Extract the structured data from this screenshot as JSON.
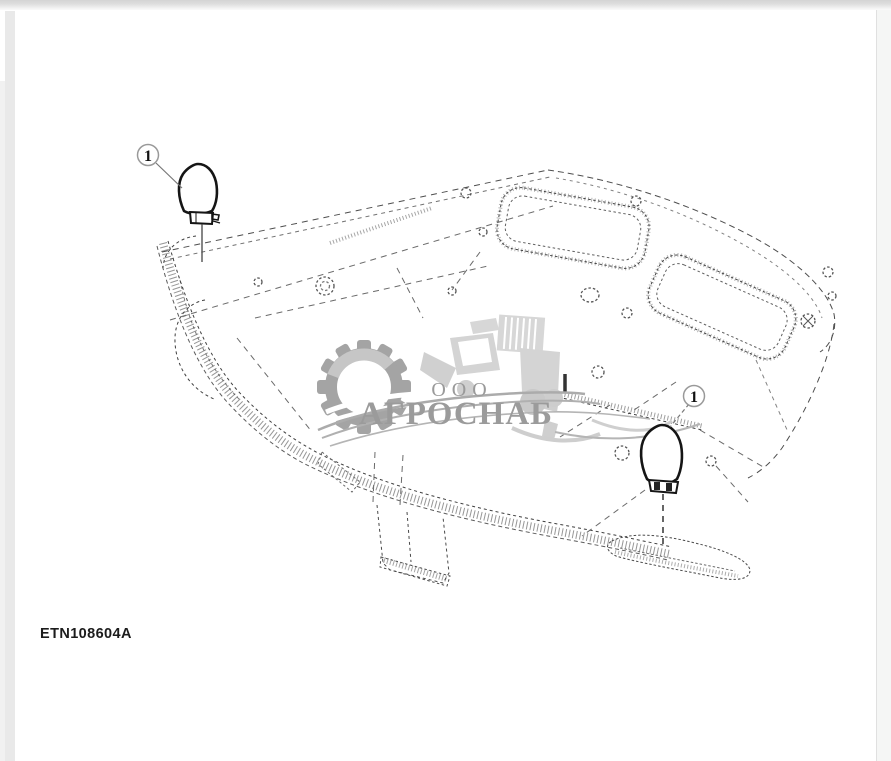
{
  "diagram": {
    "part_code": "ETN108604A",
    "callouts": [
      {
        "label": "1"
      },
      {
        "label": "1"
      }
    ],
    "watermark": {
      "org_form": "ООО",
      "company": "АГРОСНАБ",
      "color": "#9b9b9b",
      "icons": [
        "gear-icon",
        "tractor-icon"
      ]
    },
    "line_color": "#4d4d4d"
  }
}
